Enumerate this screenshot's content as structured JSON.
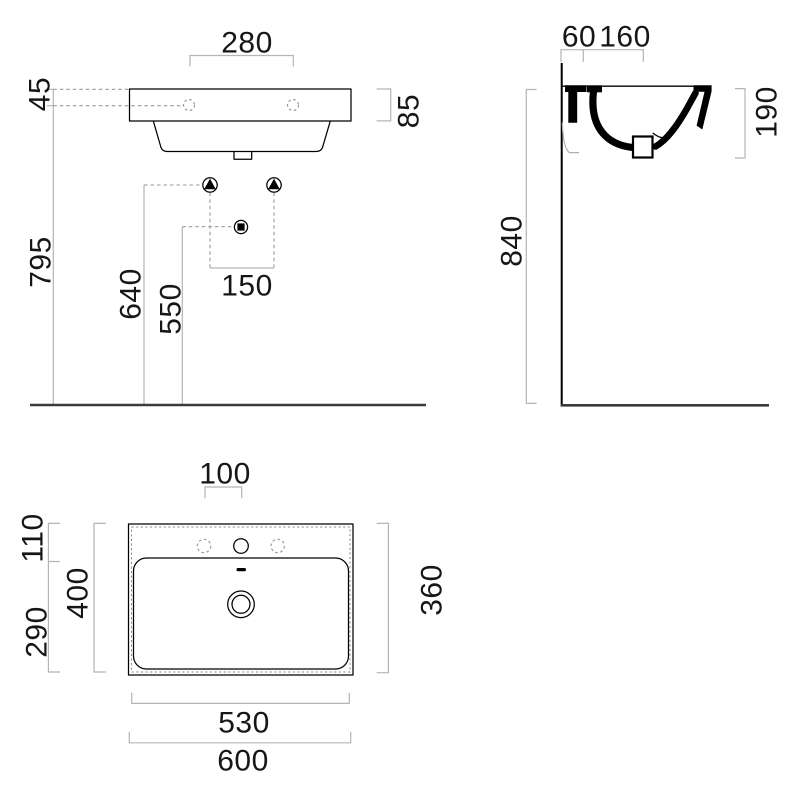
{
  "colors": {
    "outline": "#000000",
    "dimension_line": "#b5b5b5",
    "dashed_line": "#9a9a9a",
    "floor_line": "#3a3a3a",
    "text": "#161616",
    "background": "#ffffff"
  },
  "front_view": {
    "label_tap_hole_spacing": "280",
    "label_rim_to_tap_axis": "45",
    "label_apron_height": "85",
    "label_tap_axis_height": "795",
    "label_bracket_height": "640",
    "label_drain_height": "550",
    "label_bracket_spacing": "150"
  },
  "side_view": {
    "label_wall_to_hole": "60",
    "label_hole_to_tap": "160",
    "label_section_depth": "190",
    "label_rim_height": "840"
  },
  "plan_view": {
    "label_tap_hole_pitch": "100",
    "label_rim_to_bowl": "110",
    "label_bowl_rear_depth": "290",
    "label_overall_depth": "400",
    "label_inner_depth": "360",
    "label_bowl_width": "530",
    "label_overall_width": "600"
  }
}
